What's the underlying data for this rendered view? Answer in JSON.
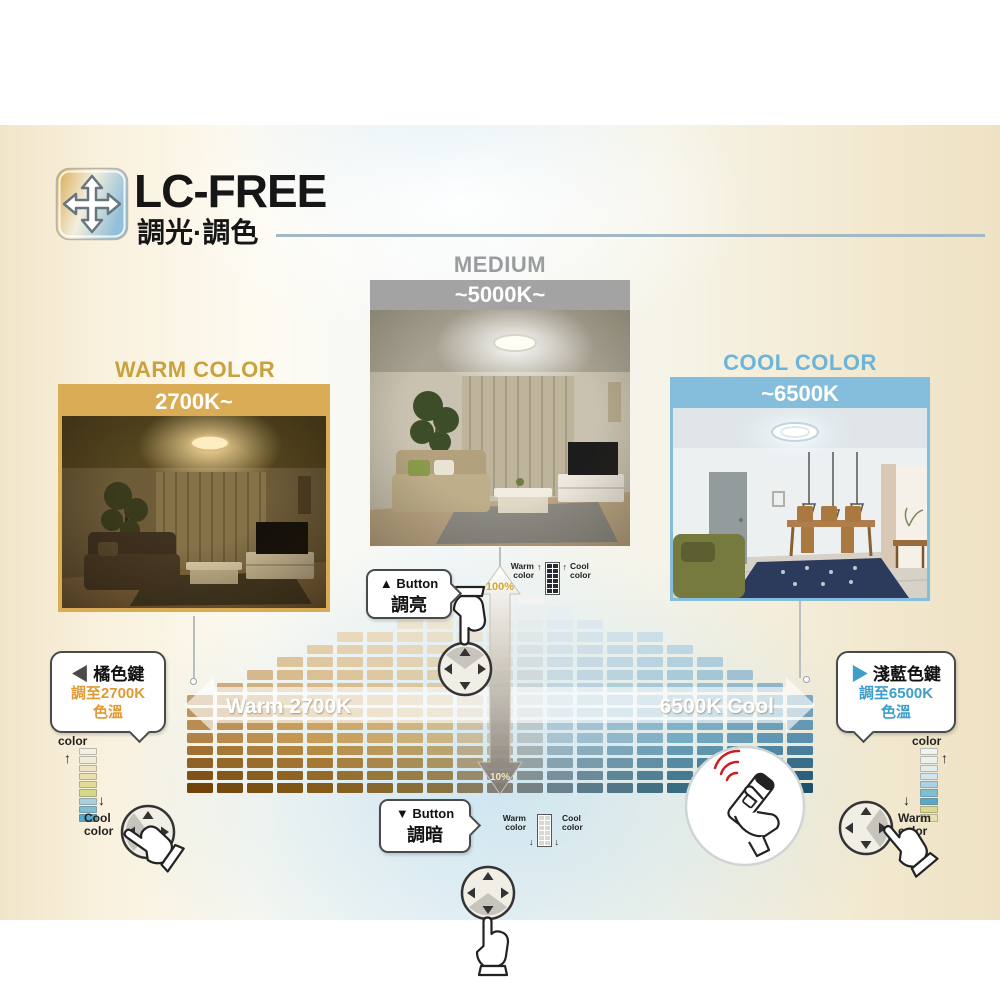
{
  "header": {
    "title": "LC-FREE",
    "subtitle": "調光·調色",
    "logo_icon": "four-direction-arrows-icon",
    "logo_gradient": [
      "#d8a94e",
      "#f4eedd",
      "#93bfda"
    ],
    "rule_color": "#a2b8c4"
  },
  "photos": {
    "medium": {
      "label": "MEDIUM",
      "banner": "~5000K~",
      "accent": "#9a9da0",
      "banner_bg": "#a3a3a3"
    },
    "warm": {
      "label": "WARM COLOR",
      "banner": "2700K~",
      "accent": "#c9a23e",
      "banner_bg": "#d9ac55"
    },
    "cool": {
      "label": "COOL COLOR",
      "banner": "~6500K",
      "accent": "#6cb4d8",
      "banner_bg": "#85bedd"
    }
  },
  "callouts": {
    "brighten": {
      "arrow": "▲",
      "keyword": "Button",
      "action": "調亮"
    },
    "dim": {
      "arrow": "▼",
      "keyword": "Button",
      "action": "調暗"
    },
    "orange_key": {
      "arrow": "◀",
      "title": "橘色鍵",
      "line2": "調至2700K",
      "line3": "色溫",
      "accent": "#e09a33",
      "arrow_color": "#4a4a4a"
    },
    "lightblue_key": {
      "arrow": "▶",
      "title": "淺藍色鍵",
      "line2": "調至6500K",
      "line3": "色溫",
      "accent": "#3d9ec9",
      "arrow_color": "#3d9ec9"
    }
  },
  "legend": {
    "warm": "Warm color",
    "cool": "Cool color",
    "warm_side_segments": [
      "#f2efe4",
      "#f0ebd8",
      "#ece4c4",
      "#e7dfae",
      "#dfdc9a",
      "#d6d98a",
      "#a9cfdd",
      "#7fbcd6",
      "#55a8c8"
    ],
    "cool_side_segments": [
      "#f2f2ef",
      "#eef0ee",
      "#e2edf2",
      "#cfe5ef",
      "#a9d2e6",
      "#7fbcd6",
      "#58a9c9",
      "#dbd98e",
      "#e7e0ae"
    ],
    "mini_dark_cell": "#262c33",
    "mini_light_cell": "#d8d8d2"
  },
  "chart_data": {
    "type": "heatmap",
    "shape": "pyramid",
    "x_label_left": "Warm 2700K",
    "x_label_right": "6500K Cool",
    "x_range_kelvin": [
      2700,
      6500
    ],
    "y_label_top": "100%",
    "y_label_bottom": "10%",
    "y_meaning": "brightness percent, 100% at top to 10% at bottom",
    "columns": 21,
    "rows_center": 17,
    "rows_edge": 8,
    "color_stops": [
      [
        0.0,
        "#9c5f10"
      ],
      [
        0.2,
        "#b87f24"
      ],
      [
        0.4,
        "#bfa05c"
      ],
      [
        0.5,
        "#b7b2a6"
      ],
      [
        0.6,
        "#8fb3c4"
      ],
      [
        0.8,
        "#4f94b4"
      ],
      [
        1.0,
        "#2a7096"
      ]
    ],
    "band_fill": "rgba(255,255,255,0.62)",
    "band_text_color": "#ffffff",
    "pct_top_color": "#d4a92c",
    "pct_bottom_color": "#f2e8c0"
  },
  "icons": {
    "logo": "four-direction-arrows-icon",
    "dpad": "circular-dpad-button-icon",
    "hand": "pressing-hand-icon",
    "remote": "hand-holding-remote-icon",
    "signal": "red-signal-waves-icon"
  }
}
